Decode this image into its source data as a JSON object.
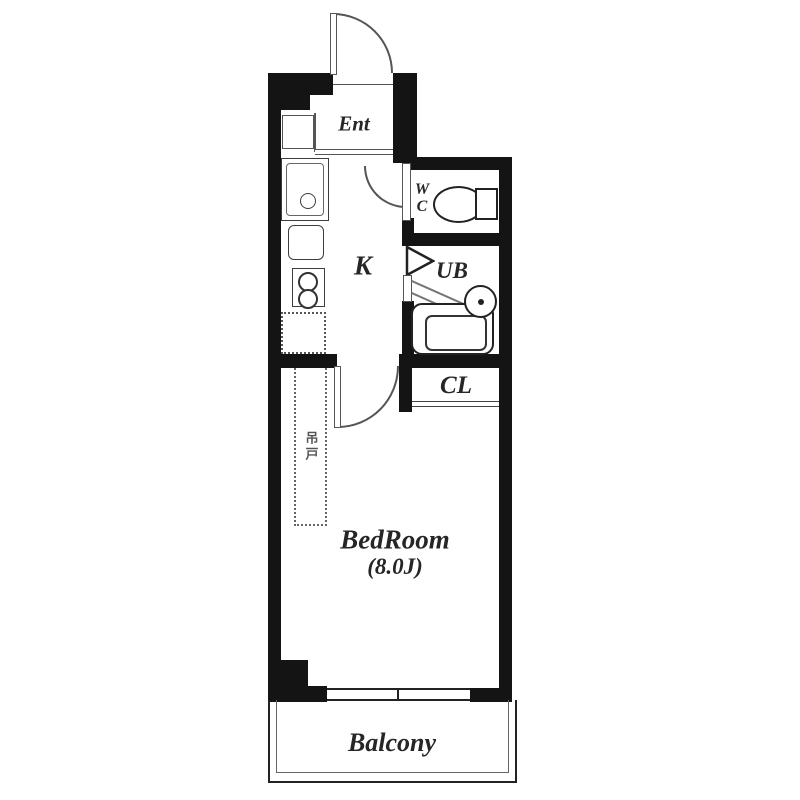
{
  "floorplan": {
    "labels": {
      "entrance": "Ent",
      "kitchen": "K",
      "wc_top": "W",
      "wc_bottom": "C",
      "unit_bath": "UB",
      "closet": "CL",
      "bedroom": "BedRoom",
      "bedroom_size": "(8.0J)",
      "balcony": "Balcony",
      "hanging_door": "吊戸"
    },
    "colors": {
      "wall": "#141414",
      "fixture_line": "#3d3d3d",
      "door_line": "#555555",
      "text": "#262626",
      "background": "#ffffff"
    }
  }
}
